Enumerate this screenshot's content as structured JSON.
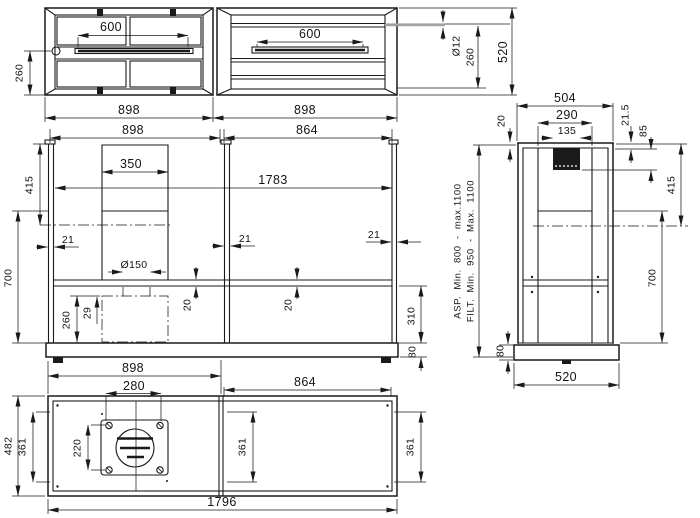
{
  "views": {
    "plan_left": {
      "slot": "600",
      "offset": "260",
      "width": "898"
    },
    "plan_right": {
      "slot": "600",
      "width": "898",
      "rod_dia": "Ø12",
      "rod_offset": "260",
      "depth": "520"
    },
    "front": {
      "section_left": "898",
      "section_right": "864",
      "chimney": "350",
      "span": "1783",
      "panel": "21",
      "upper_height": "415",
      "body_height": "700",
      "duct_dia": "Ø150",
      "filter_height": "260",
      "filter_gap": "29",
      "shelf": "20",
      "lower_height": "310",
      "base_height": "80",
      "base_width": "898"
    },
    "side": {
      "depth": "504",
      "inner_depth": "290",
      "duct_width": "135",
      "top_frame": "20",
      "rear_gap": "21.5",
      "duct_drop": "85",
      "upper_height": "415",
      "body_height": "700",
      "base_height": "80",
      "base_depth": "520",
      "asp_range": "ASP. Min. 800 - max.1100",
      "filt_range": "FILT. Min. 950 - Max. 1100"
    },
    "bottom": {
      "plate_width": "280",
      "section_right": "864",
      "plate_height": "220",
      "bay_left": "361",
      "bay_mid": "361",
      "bay_right": "361",
      "depth": "482",
      "length": "1796"
    }
  }
}
